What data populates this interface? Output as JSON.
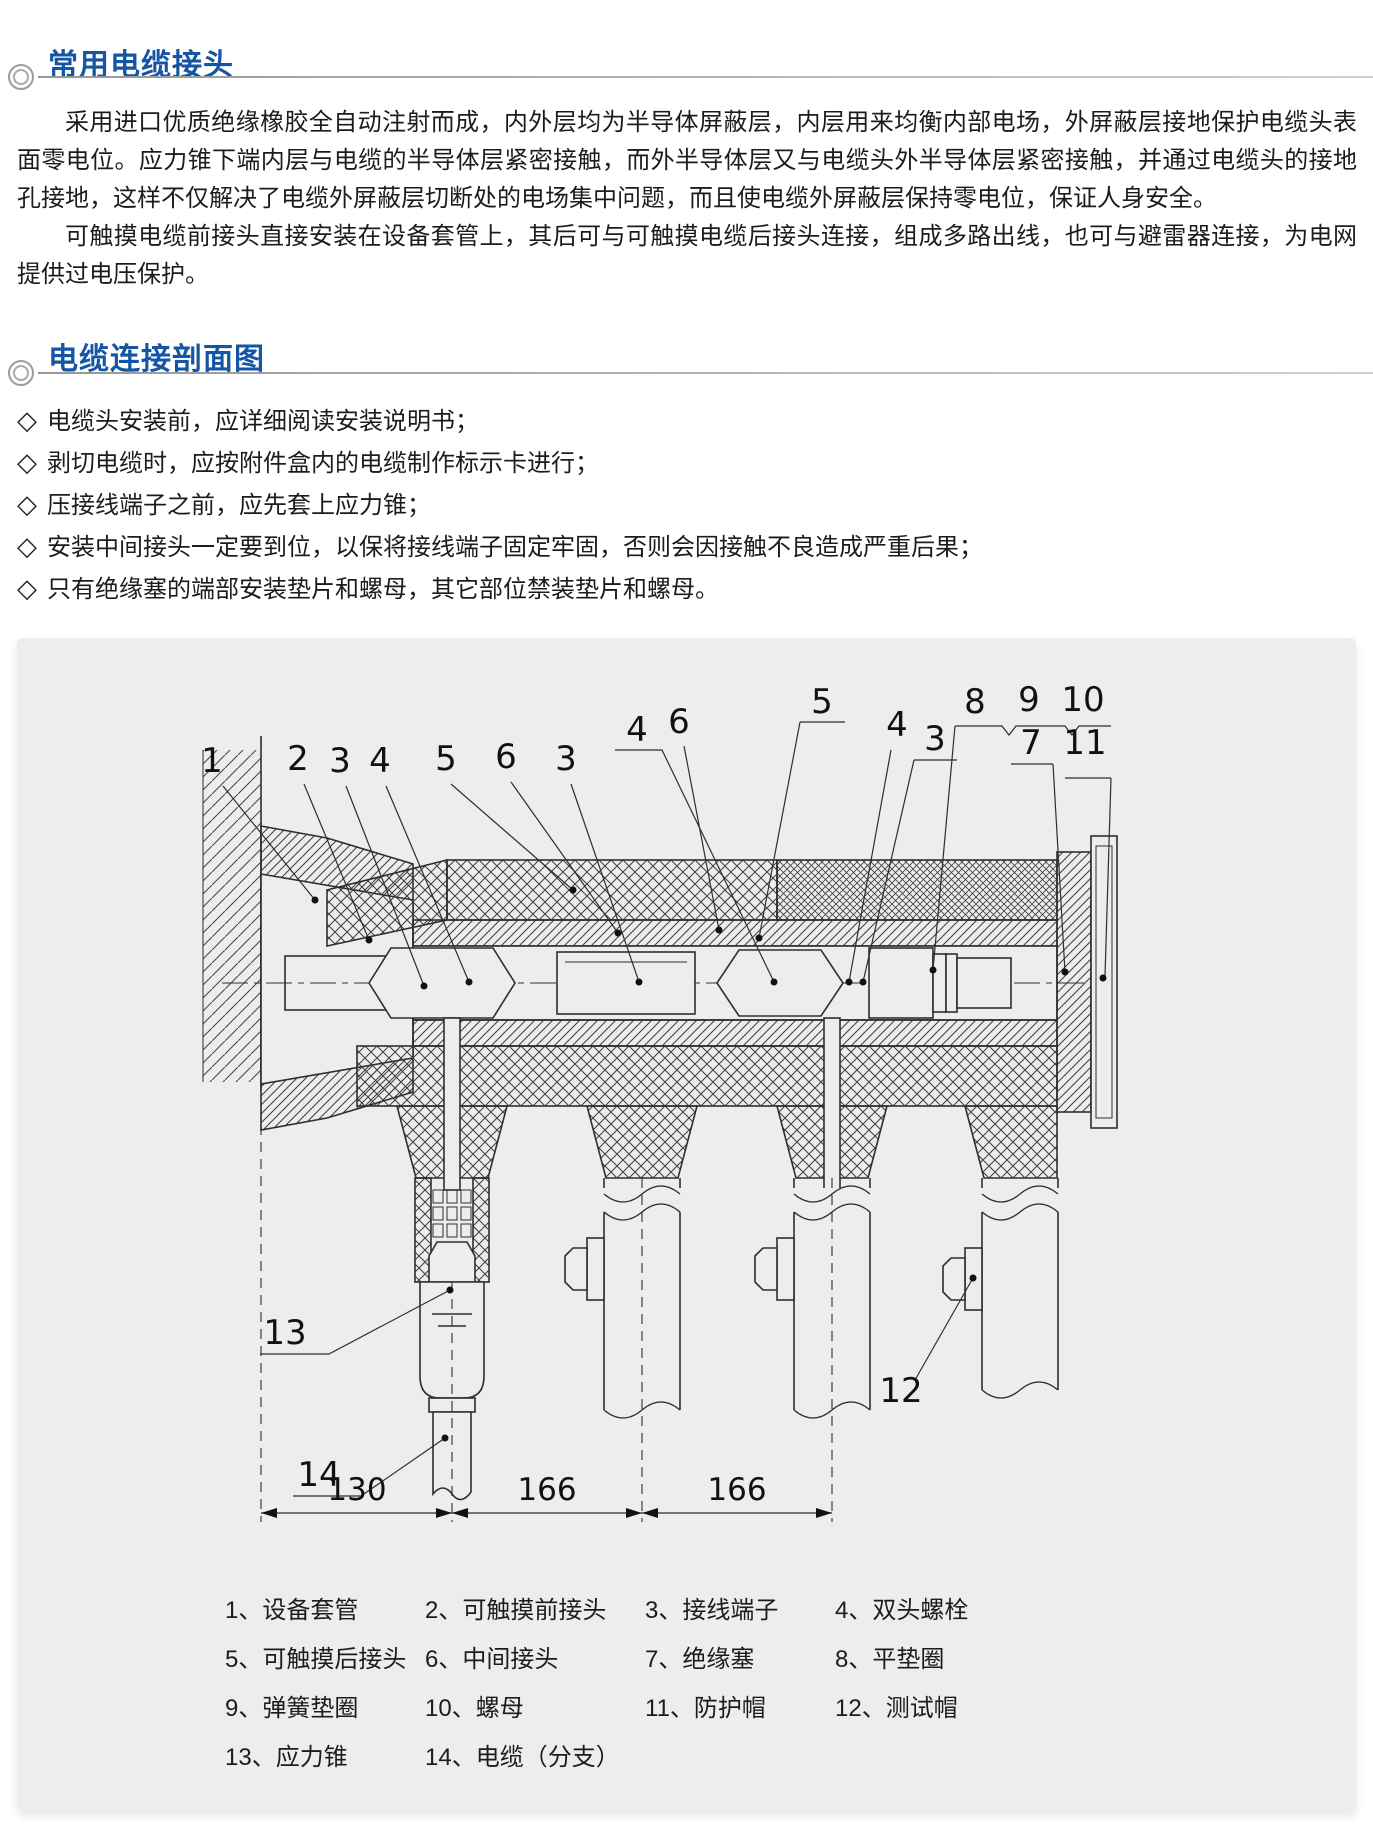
{
  "colors": {
    "accent": "#1456a5",
    "panel_bg": "#ecedee",
    "ink": "#1c1c1c",
    "drawing_stroke": "#2e2e2e"
  },
  "section1": {
    "title": "常用电缆接头",
    "paragraphs": [
      "采用进口优质绝缘橡胶全自动注射而成，内外层均为半导体屏蔽层，内层用来均衡内部电场，外屏蔽层接地保护电缆头表面零电位。应力锥下端内层与电缆的半导体层紧密接触，而外半导体层又与电缆头外半导体层紧密接触，并通过电缆头的接地孔接地，这样不仅解决了电缆外屏蔽层切断处的电场集中问题，而且使电缆外屏蔽层保持零电位，保证人身安全。",
      "可触摸电缆前接头直接安装在设备套管上，其后可与可触摸电缆后接头连接，组成多路出线，也可与避雷器连接，为电网提供过电压保护。"
    ]
  },
  "section2": {
    "title": "电缆连接剖面图",
    "bullet": "◇",
    "notes": [
      "电缆头安装前，应详细阅读安装说明书；",
      "剥切电缆时，应按附件盒内的电缆制作标示卡进行；",
      "压接线端子之前，应先套上应力锥；",
      "安装中间接头一定要到位，以保将接线端子固定牢固，否则会因接触不良造成严重后果；",
      "只有绝缘塞的端部安装垫片和螺母，其它部位禁装垫片和螺母。"
    ]
  },
  "diagram": {
    "callouts": [
      {
        "t": "1",
        "x": 195,
        "y": 134
      },
      {
        "t": "2",
        "x": 281,
        "y": 132
      },
      {
        "t": "3",
        "x": 323,
        "y": 134
      },
      {
        "t": "4",
        "x": 363,
        "y": 134
      },
      {
        "t": "5",
        "x": 429,
        "y": 132
      },
      {
        "t": "6",
        "x": 489,
        "y": 130
      },
      {
        "t": "3",
        "x": 549,
        "y": 132
      },
      {
        "t": "4",
        "x": 620,
        "y": 103
      },
      {
        "t": "6",
        "x": 662,
        "y": 95
      },
      {
        "t": "5",
        "x": 805,
        "y": 75
      },
      {
        "t": "4",
        "x": 880,
        "y": 98
      },
      {
        "t": "3",
        "x": 918,
        "y": 112
      },
      {
        "t": "8",
        "x": 958,
        "y": 75
      },
      {
        "t": "9",
        "x": 1012,
        "y": 73
      },
      {
        "t": "10",
        "x": 1066,
        "y": 73
      },
      {
        "t": "7",
        "x": 1014,
        "y": 116
      },
      {
        "t": "11",
        "x": 1068,
        "y": 116
      },
      {
        "t": "12",
        "x": 884,
        "y": 764
      },
      {
        "t": "13",
        "x": 268,
        "y": 706
      },
      {
        "t": "14",
        "x": 302,
        "y": 848
      }
    ],
    "dimensions": [
      {
        "t": "130",
        "x": 340,
        "y": 862
      },
      {
        "t": "166",
        "x": 530,
        "y": 862
      },
      {
        "t": "166",
        "x": 720,
        "y": 862
      }
    ],
    "legend_separator": "、",
    "legend_items": [
      {
        "num": "1",
        "label": "设备套管"
      },
      {
        "num": "2",
        "label": "可触摸前接头"
      },
      {
        "num": "3",
        "label": "接线端子"
      },
      {
        "num": "4",
        "label": "双头螺栓"
      },
      {
        "num": "5",
        "label": "可触摸后接头"
      },
      {
        "num": "6",
        "label": "中间接头"
      },
      {
        "num": "7",
        "label": "绝缘塞"
      },
      {
        "num": "8",
        "label": "平垫圈"
      },
      {
        "num": "9",
        "label": "弹簧垫圈"
      },
      {
        "num": "10",
        "label": "螺母"
      },
      {
        "num": "11",
        "label": "防护帽"
      },
      {
        "num": "12",
        "label": "测试帽"
      },
      {
        "num": "13",
        "label": "应力锥"
      },
      {
        "num": "14",
        "label": "电缆（分支）"
      }
    ]
  }
}
